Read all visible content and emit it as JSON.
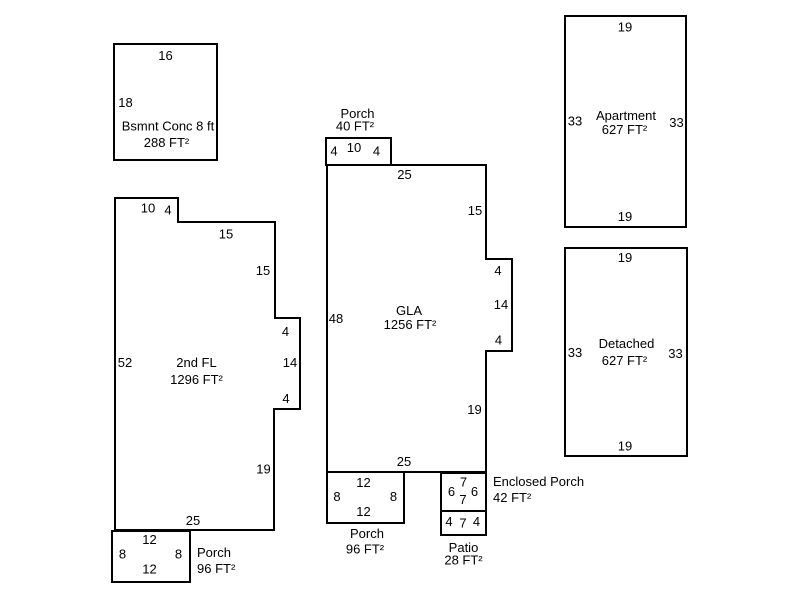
{
  "colors": {
    "background": "#ffffff",
    "line": "#000000",
    "text": "#000000"
  },
  "sketch": {
    "bsmnt": {
      "name": "Bsmnt Conc 8 ft",
      "area": "288 FT²",
      "top": "16",
      "left": "18"
    },
    "second_floor": {
      "name": "2nd FL",
      "area": "1296 FT²",
      "top_a": "10",
      "step": "4",
      "top_b": "15",
      "right_a": "15",
      "bump_top": "4",
      "bump_right": "14",
      "bump_bottom": "4",
      "right_b": "19",
      "bottom": "25",
      "left": "52"
    },
    "porch_sw": {
      "name": "Porch",
      "area": "96 FT²",
      "top": "12",
      "left": "8",
      "right": "8",
      "bottom": "12"
    },
    "porch_front": {
      "name": "Porch",
      "area": "40 FT²",
      "left": "4",
      "top": "10",
      "right": "4"
    },
    "gla": {
      "name": "GLA",
      "area": "1256 FT²",
      "top": "25",
      "right_a": "15",
      "bump_top": "4",
      "bump_right": "14",
      "bump_bottom": "4",
      "right_b": "19",
      "bottom": "25",
      "left": "48"
    },
    "porch_s": {
      "name": "Porch",
      "area": "96 FT²",
      "top": "12",
      "left": "8",
      "right": "8",
      "bottom": "12"
    },
    "enclosed_porch": {
      "name": "Enclosed Porch",
      "area": "42 FT²",
      "top": "7",
      "left": "6",
      "right": "6",
      "bottom": "7"
    },
    "patio": {
      "name": "Patio",
      "area": "28 FT²",
      "left": "4",
      "width": "7",
      "right": "4"
    },
    "apartment": {
      "name": "Apartment",
      "area": "627 FT²",
      "top": "19",
      "left": "33",
      "right": "33",
      "bottom": "19"
    },
    "detached": {
      "name": "Detached",
      "area": "627 FT²",
      "top": "19",
      "left": "33",
      "right": "33",
      "bottom": "19"
    }
  }
}
